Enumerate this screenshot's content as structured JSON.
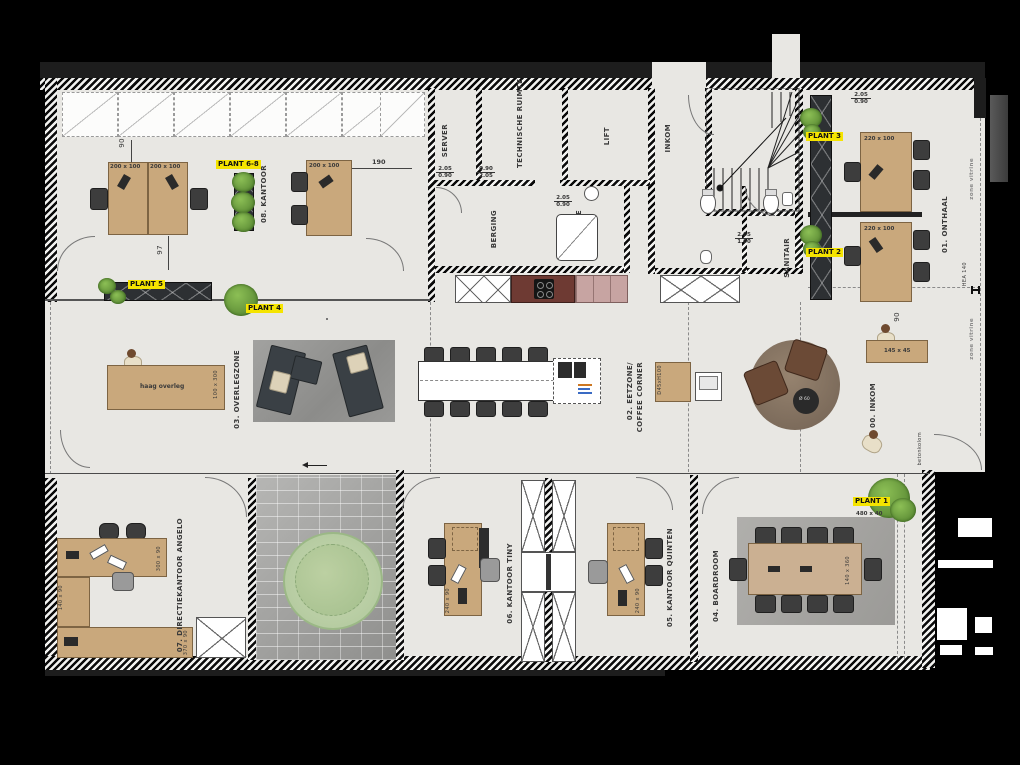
{
  "rooms": {
    "kantoor08": "08. KANTOOR",
    "server": "SERVER",
    "technische_ruimte": "TECHNISCHE RUIMTE",
    "lift": "LIFT",
    "inkom_top": "INKOM",
    "berging": "BERGING",
    "douche": "DOUCHE",
    "sanitair": "SANITAIR",
    "onthaal": "01. ONTHAAL",
    "overlegzone": "03. OVERLEGZONE",
    "eetzone_line1": "02. EETZONE/",
    "eetzone_line2": "COFFEE CORNER",
    "inkom00": "00. INKOM",
    "directie": "07. DIRECTIEKANTOOR ANGELO",
    "tiny": "06. KANTOOR TINY",
    "quinten": "05. KANTOOR QUINTEN",
    "boardroom": "04. BOARDROOM"
  },
  "plants": {
    "p1": "PLANT 1",
    "p2": "PLANT 2",
    "p3": "PLANT 3",
    "p4": "PLANT 4",
    "p5": "PLANT 5",
    "p68": "PLANT 6-8"
  },
  "sizes": {
    "desk200": "200 x 100",
    "desk220": "220 x 100",
    "desk240": "240 x 90",
    "desk300": "300 x 90",
    "desk140": "140 x 90",
    "desk370": "370 x 90",
    "console145": "145 x 45",
    "haag_table": "100 x 300",
    "board_table": "140 x 360",
    "plantbed": "480 x 40",
    "cabinet": "D45xH100",
    "round_table": "Ø 60"
  },
  "dims": {
    "d190": "190",
    "d90": "90",
    "d97": "97"
  },
  "annotations": {
    "haag_overleg": "haag overleg",
    "betonkolom": "betonkolom",
    "hea": "HEA 140",
    "vitrine": "zone vitrine"
  },
  "door_sizes": {
    "h205": "2.05",
    "w090": "0.90",
    "w100": "1.00"
  },
  "colors": {
    "highlight_yellow": "#f5e400",
    "desk_tan": "#c9a87c",
    "plant_green": "#5d8f35",
    "floor_grey": "#e8e7e3",
    "kitchen_maroon": "#6e3a33",
    "cabinet_pink": "#c7a4a2"
  }
}
